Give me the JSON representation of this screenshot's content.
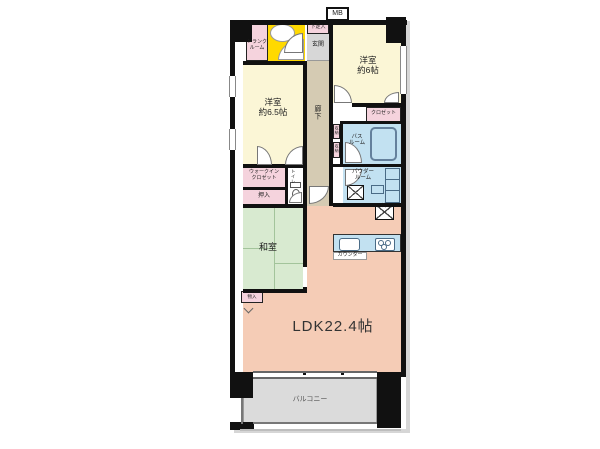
{
  "floorplan": {
    "title": "LDK22.4帖",
    "labels": {
      "mb": "MB",
      "trunk1": "トランク",
      "trunk2": "ルーム",
      "shoe": "下足入",
      "genkan": "玄関",
      "west6_1": "洋室",
      "west6_2": "約6帖",
      "west65_1": "洋室",
      "west65_2": "約6.5帖",
      "hallway": "廊下",
      "closet": "クロゼット",
      "bath1": "バス",
      "bath2": "ルーム",
      "powder1": "パウダー",
      "powder2": "ルーム",
      "storage_a": "収納",
      "storage_b": "収納",
      "wic1": "ウォークイン",
      "wic2": "クロゼット",
      "toilet": "トイレ",
      "oshiire": "押入",
      "washitsu": "和室",
      "monoire": "物入",
      "counter": "カウンター",
      "fridge": "冷",
      "ldk": "LDK22.4帖",
      "balcony": "バルコニー"
    },
    "colors": {
      "wall": "#111111",
      "western_room": "#FBF6D6",
      "hallway": "#D5CBB3",
      "genkan": "#D7D7D7",
      "storage_pink": "#F5D3DD",
      "wet_area_blue": "#C2E1F1",
      "tatami_green": "#D8EAD0",
      "ldk_salmon": "#F5CCB6",
      "balcony_gray": "#DBDBDB",
      "stairs_yellow": "#FFD900"
    }
  }
}
